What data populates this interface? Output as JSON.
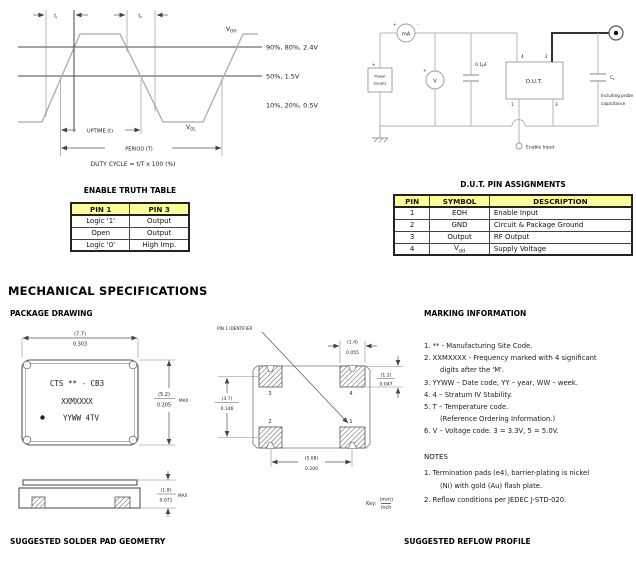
{
  "timing_diagram": {
    "tr": "t",
    "tr_sub": "r",
    "tf": "t",
    "tf_sub": "f",
    "voh": "V",
    "voh_sub": "OH",
    "vol": "V",
    "vol_sub": "OL",
    "levels": [
      "90%, 80%, 2.4V",
      "50%, 1.5V",
      "10%, 20%, 0.5V"
    ],
    "uptime": "UPTIME (t)",
    "period": "PERIOD (T)",
    "duty": "DUTY CYCLE = t/T x 100 (%)"
  },
  "circuit": {
    "power1": "Power",
    "power2": "Supply",
    "ammeter": "mA",
    "voltmeter": "V",
    "bypass_cap": "0.1µF",
    "dut": "D.U.T.",
    "pin4": "4",
    "pin2": "2",
    "pin1": "1",
    "pin3": "3",
    "cl": "C",
    "cl_sub": "L",
    "probe1": "Including probe",
    "probe2": "capacitance",
    "enable_input": "Enable Input",
    "plus": "+",
    "minus": "-"
  },
  "truth_table": {
    "title": "ENABLE TRUTH TABLE",
    "headers": [
      "PIN 1",
      "PIN 3"
    ],
    "rows": [
      [
        "Logic '1'",
        "Output"
      ],
      [
        "Open",
        "Output"
      ],
      [
        "Logic '0'",
        "High Imp."
      ]
    ]
  },
  "pin_table": {
    "title": "D.U.T. PIN ASSIGNMENTS",
    "headers": [
      "PIN",
      "SYMBOL",
      "DESCRIPTION"
    ],
    "rows": [
      {
        "pin": "1",
        "symbol": "EOH",
        "desc": "Enable Input"
      },
      {
        "pin": "2",
        "symbol": "GND",
        "desc": "Circuit & Package Ground"
      },
      {
        "pin": "3",
        "symbol": "Output",
        "desc": "RF Output"
      },
      {
        "pin": "4",
        "symbol": "V",
        "sub": "dd",
        "desc": "Supply Voltage"
      }
    ]
  },
  "mech": {
    "heading": "MECHANICAL SPECIFICATIONS",
    "package_drawing": "PACKAGE DRAWING",
    "solder_pad": "SUGGESTED SOLDER PAD GEOMETRY",
    "reflow": "SUGGESTED REFLOW PROFILE",
    "key": "Key:",
    "key_mm": "(mm)",
    "key_inch": "inch"
  },
  "package": {
    "mark1": "CTS ** - CB3",
    "mark2": "XXMXXXX",
    "mark3": "YYWW 4TV",
    "dim_w_mm": "(7.7)",
    "dim_w_in": "0.303",
    "dim_h_mm": "(5.2)",
    "dim_h_in": "0.205",
    "max": "MAX"
  },
  "land": {
    "pin1_id": "PIN 1 IDENTIFIER",
    "p3": "3",
    "p4": "4",
    "p2": "2",
    "p1": "1",
    "dim_pw_mm": "(1.4)",
    "dim_pw_in": "0.055",
    "dim_ph_mm": "(1.2)",
    "dim_ph_in": "0.047",
    "dim_v_mm": "(3.7)",
    "dim_v_in": "0.146",
    "dim_p_mm": "(5.08)",
    "dim_p_in": "0.200"
  },
  "side": {
    "dim_mm": "(1.8)",
    "dim_in": "0.071",
    "max": "MAX"
  },
  "marking": {
    "title": "MARKING INFORMATION",
    "lines": [
      "1. ** - Manufacturing Site Code.",
      "2. XXMXXXX - Frequency marked with 4 significant",
      "digits after the 'M'.",
      "3. YYWW – Date code, YY – year, WW – week.",
      "4. 4 – Stratum IV Stability.",
      "5. T – Temperature code.",
      "(Reference Ordering Information.)",
      "6. V – Voltage code. 3 = 3.3V, 5 = 5.0V."
    ]
  },
  "notes": {
    "title": "NOTES",
    "lines": [
      "1. Termination pads (e4), barrier-plating is nickel",
      "(Ni) with gold (Au) flash plate.",
      "2. Reflow conditions per JEDEC J-STD-020."
    ]
  },
  "colors": {
    "table_header": "#ffff99",
    "trace_gray": "#aaaaaa"
  }
}
